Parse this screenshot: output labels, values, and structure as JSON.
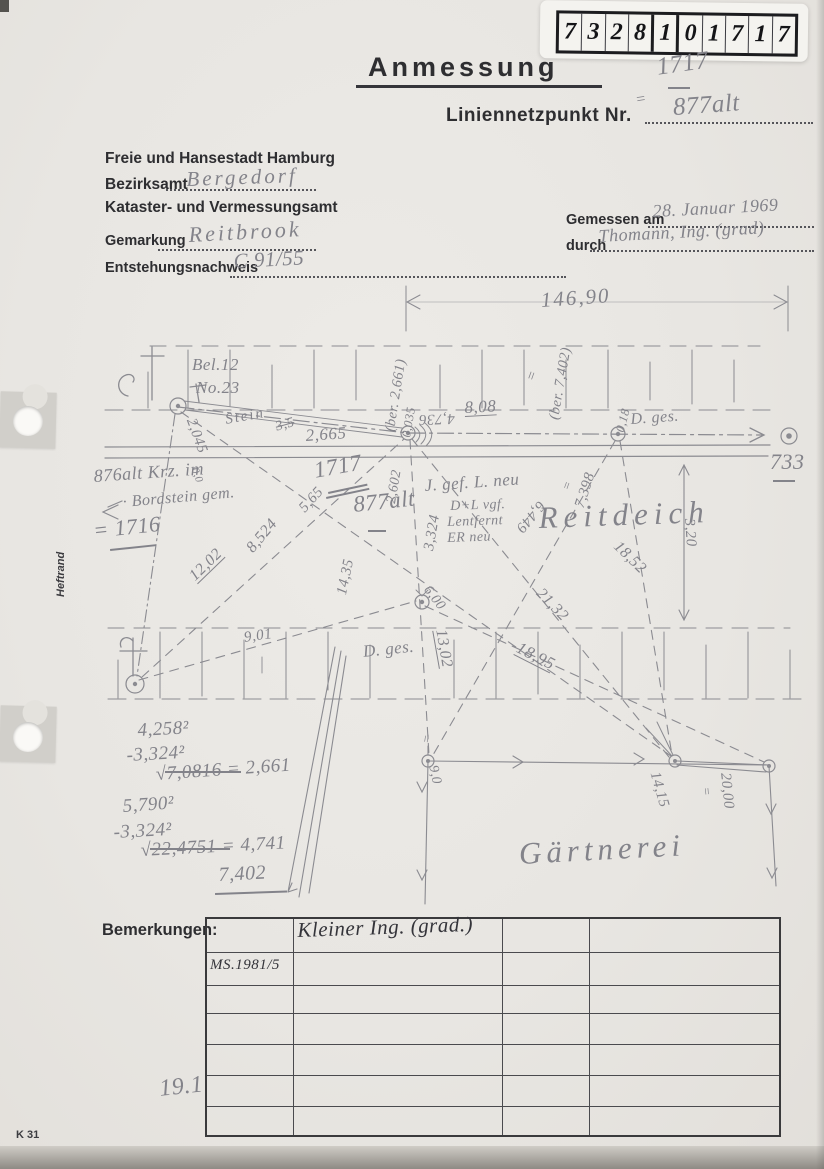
{
  "stamp": {
    "digits": [
      "7",
      "3",
      "2",
      "8",
      "1",
      "0",
      "1",
      "7",
      "1",
      "7"
    ]
  },
  "title": "Anmessung",
  "net_point": {
    "label": "Liniennetzpunkt Nr.",
    "value": "877alt",
    "old_value": "1717",
    "eq": "="
  },
  "header": {
    "city": "Freie und Hansestadt Hamburg",
    "bezirksamt_label": "Bezirksamt",
    "bezirksamt_value": "Bergedorf",
    "amt": "Kataster- und Vermessungsamt",
    "gemarkung_label": "Gemarkung",
    "gemarkung_value": "Reitbrook",
    "entstehung_label": "Entstehungsnachweis",
    "entstehung_value": "C 91/55",
    "gemessen_label": "Gemessen am",
    "gemessen_value": "28. Januar 1969",
    "durch_label": "durch",
    "durch_value": "Thomann, Ing. (grad)"
  },
  "sketch": {
    "dim_total": "146,90",
    "bel": "Bel.12",
    "no": "No.23",
    "v00": "0,0",
    "v2045": "2,045",
    "stein": "Stein",
    "struck": "3,5",
    "v2665": "2,665",
    "ber2661": "(ber. 2,661)",
    "v0035": "0,035",
    "v808": "8,08",
    "v4736": "4,736",
    "ber7402": "(ber. 7,402)",
    "v018": "0,18",
    "dges": "D. ges.",
    "v733": "733",
    "p876": "876alt Krz. im",
    "bordstein": "· Bordstein gem.",
    "p1716": "= 1716",
    "p1717": "1717",
    "p877": "877alt",
    "v565": "5,65",
    "v8524": "8,524",
    "v1202": "12,02",
    "v2602": "2,602",
    "v3324": "3,324",
    "v1435": "14,35",
    "note1": "J. gef. L. neu",
    "note2": "D+L vgf.",
    "note3": "Lentfernt",
    "note4": "ER neu",
    "v6449": "6,449",
    "v7398": "7,398",
    "reitdeich": "Reitdeich",
    "v320": "3,20",
    "v1852": "18,52",
    "v2132": "21,32",
    "v1895": "18,95",
    "v600": "6,00",
    "v1302": "13,02",
    "v901": "9,01",
    "v90": "9,0",
    "v1415": "14,15",
    "v2000": "20,00",
    "gaertnerei": "Gärtnerei",
    "eq": "="
  },
  "calc": {
    "l1": "4,258²",
    "l2": "-3,324²",
    "l3": "√7,0816  = 2,661",
    "l4": "5,790²",
    "l5": "-3,324²",
    "l6": "√22,4751 = 4,741",
    "l7": "7,402"
  },
  "table": {
    "label": "Bemerkungen:",
    "entry_top": "Kleiner Ing. (grad.)",
    "entry_ms": "MS.1981/5"
  },
  "footer": {
    "form_code": "K 31",
    "note": "19.1",
    "heftrand": "Heftrand"
  }
}
